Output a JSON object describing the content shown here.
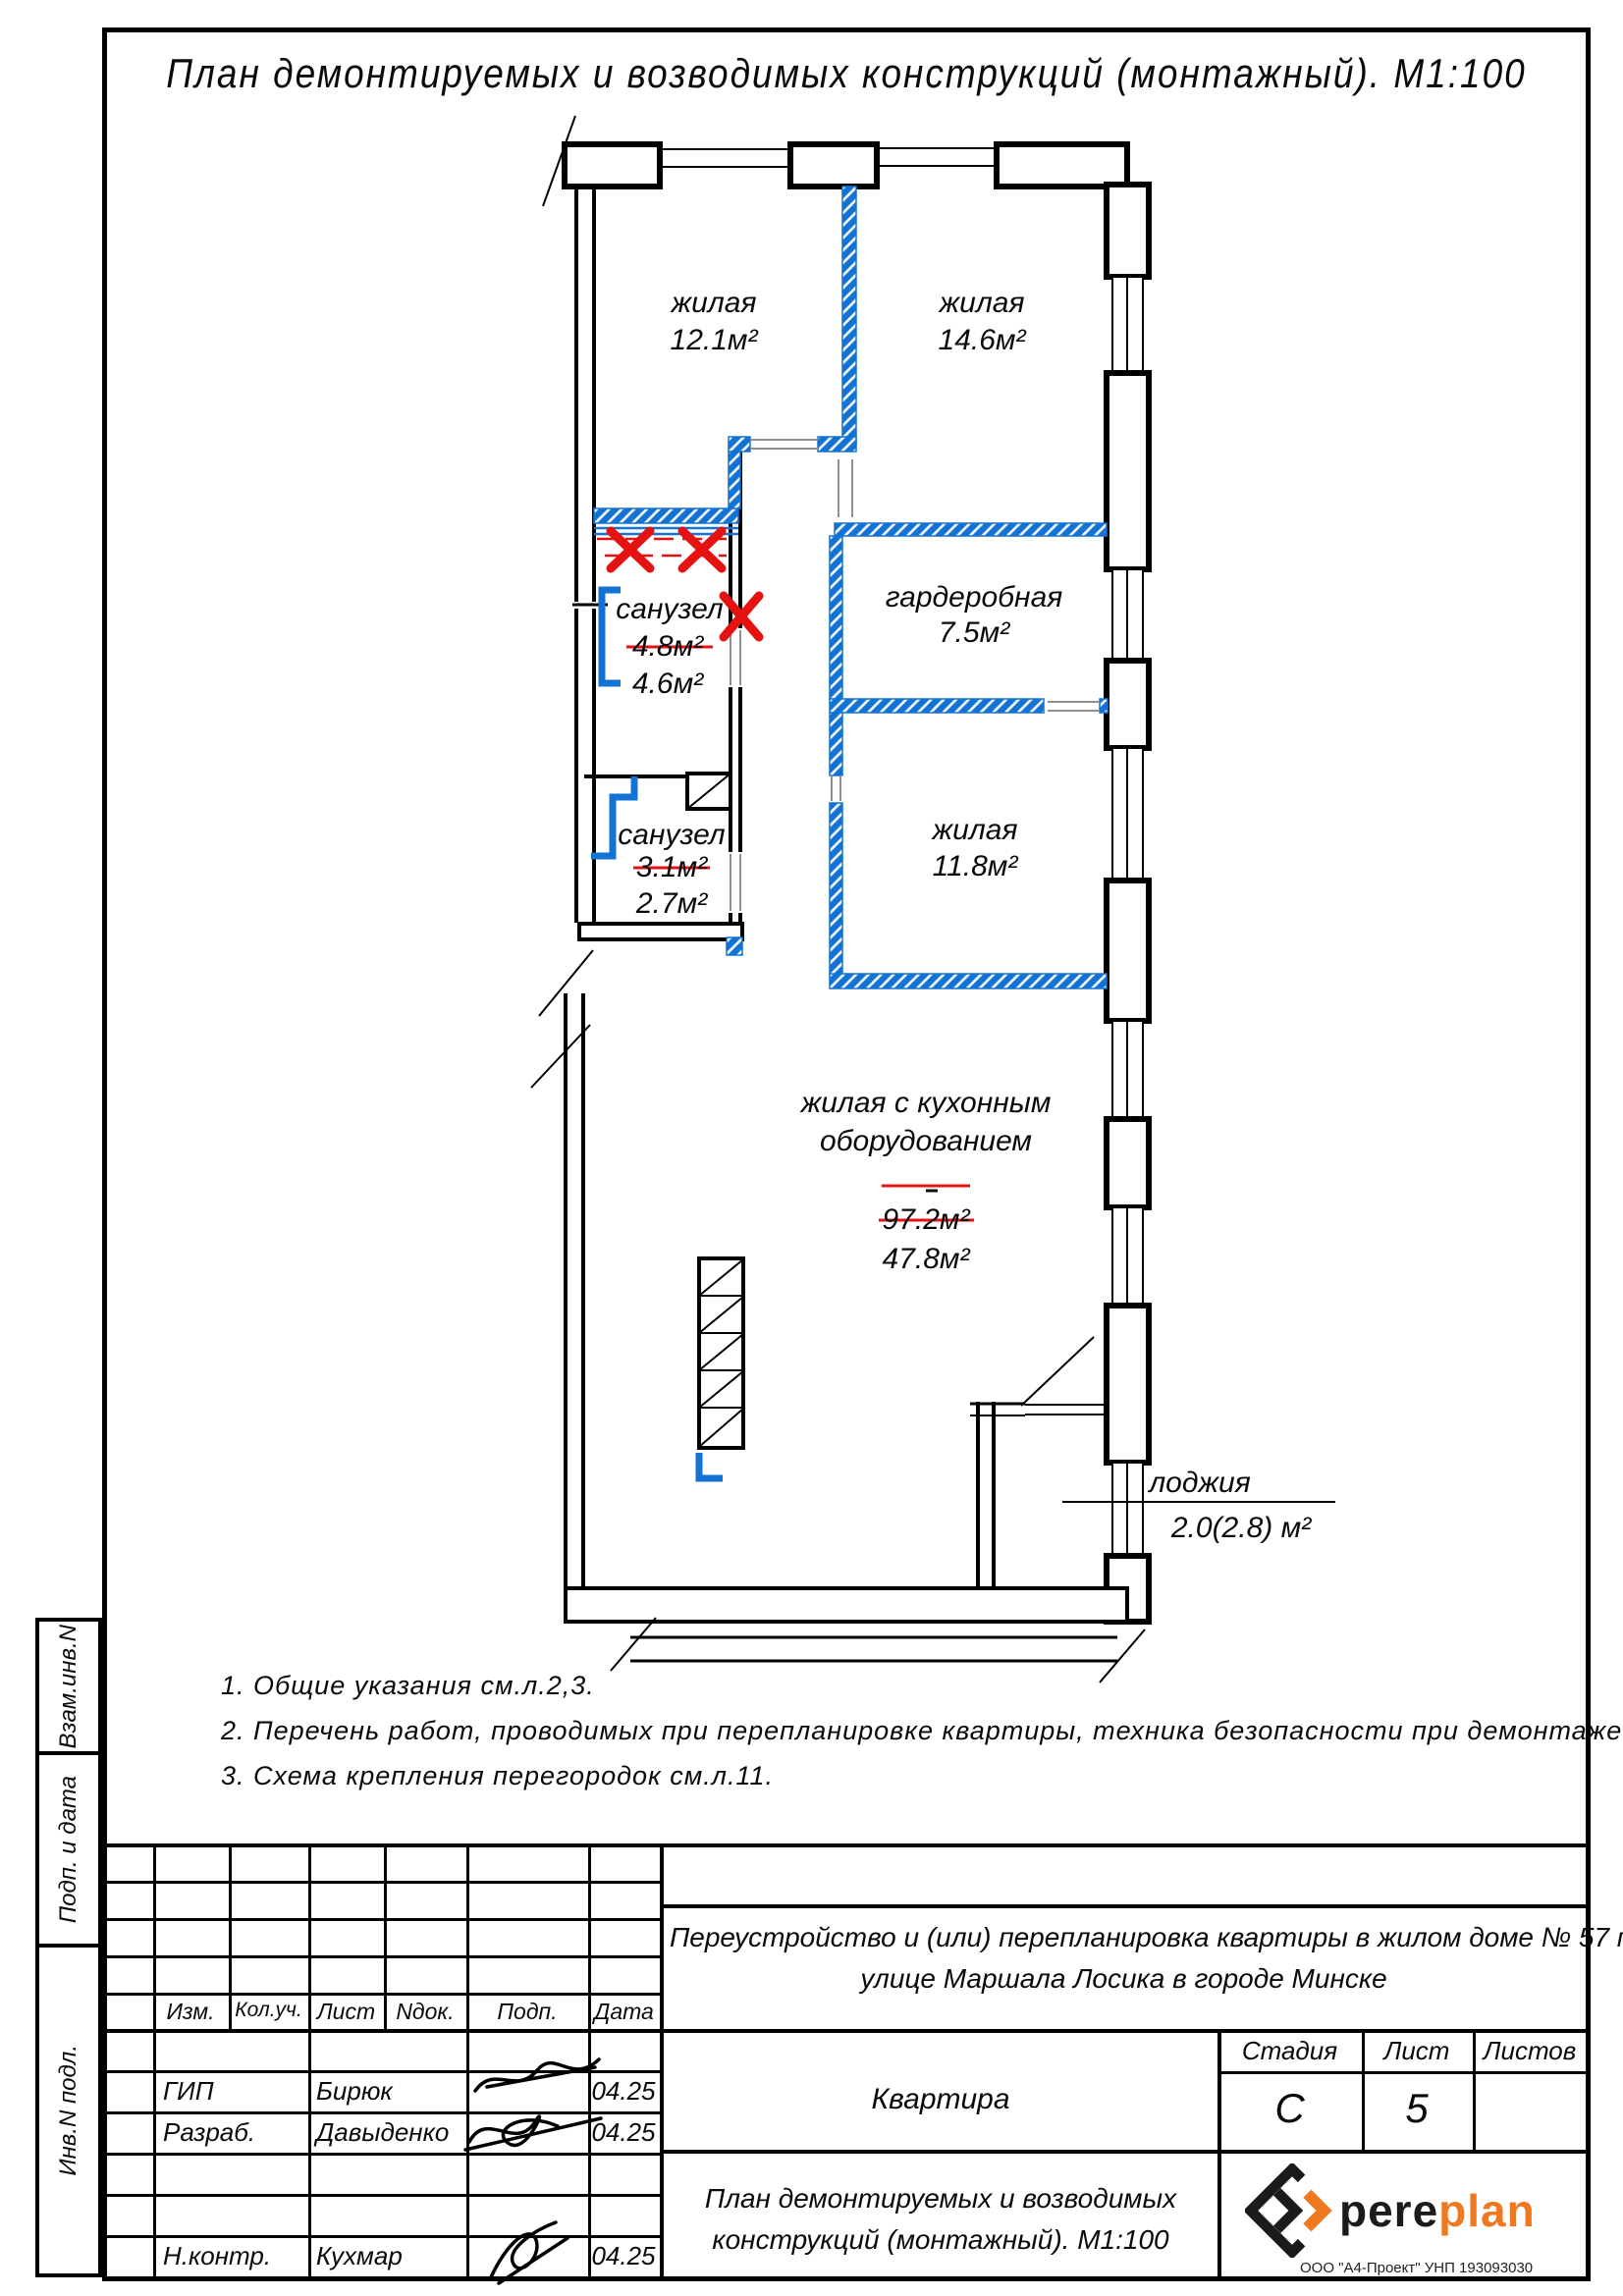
{
  "page": {
    "title": "План демонтируемых и возводимых конструкций (монтажный). М1:100"
  },
  "plan": {
    "rooms": {
      "living1": {
        "name": "жилая",
        "area": "12.1м²"
      },
      "living2": {
        "name": "жилая",
        "area": "14.6м²"
      },
      "bath1": {
        "name": "санузел",
        "area_old": "4.8м²",
        "area_new": "4.6м²"
      },
      "wardrobe": {
        "name": "гардеробная",
        "area": "7.5м²"
      },
      "living3": {
        "name": "жилая",
        "area": "11.8м²"
      },
      "bath2": {
        "name": "санузел",
        "area_old": "3.1м²",
        "area_new": "2.7м²"
      },
      "kitchen_living": {
        "name_line1": "жилая с кухонным",
        "name_line2": "оборудованием",
        "area_old": "97.2м²",
        "area_new": "47.8м²"
      },
      "loggia": {
        "name": "лоджия",
        "area": "2.0(2.8) м²"
      }
    }
  },
  "notes": [
    "1. Общие указания см.л.2,3.",
    "2. Перечень работ, проводимых при перепланировке квартиры, техника безопасности при демонтаже см.л.6.",
    "3. Схема крепления перегородок см.л.11."
  ],
  "sidebar": {
    "labels": [
      "Взам.инв.N",
      "Подп. и дата",
      "Инв.N подл."
    ]
  },
  "titleblock": {
    "columns": [
      "Изм.",
      "Кол.уч.",
      "Лист",
      "Nдок.",
      "Подп.",
      "Дата"
    ],
    "rows": [
      {
        "role": "ГИП",
        "name": "Бирюк",
        "date": "04.25"
      },
      {
        "role": "Разраб.",
        "name": "Давыденко",
        "date": "04.25"
      },
      {
        "role": "Н.контр.",
        "name": "Кухмар",
        "date": "04.25"
      }
    ],
    "project_line1": "Переустройство и (или) перепланировка квартиры в жилом доме № 57 по",
    "project_line2": "улице Маршала Лосика в городе Минске",
    "object": "Квартира",
    "stage_label": "Стадия",
    "sheet_label": "Лист",
    "sheets_label": "Листов",
    "stage": "С",
    "sheet": "5",
    "drawing_title_line1": "План демонтируемых и возводимых",
    "drawing_title_line2": "конструкций (монтажный). М1:100",
    "logo": {
      "pere": "pere",
      "plan": "plan",
      "company": "ООО \"А4-Проект\" УНП 193093030"
    }
  },
  "colors": {
    "new_wall_blue": "#1273d4",
    "demolition_red": "#e51212",
    "logo_orange": "#f0791f"
  }
}
